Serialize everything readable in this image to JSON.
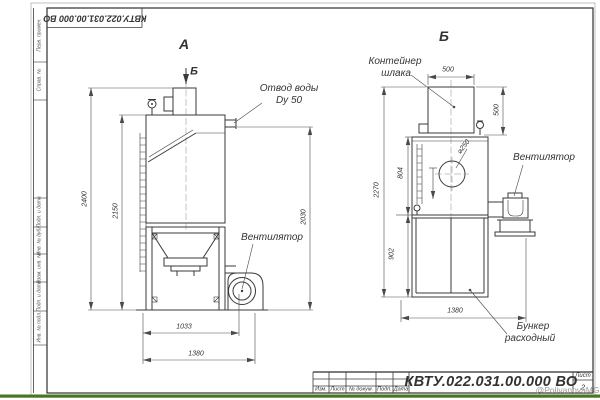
{
  "frame": {
    "top_designation": "КВТУ.022.031.00.000  ВО",
    "left_labels": {
      "perv": "Перв. примен.",
      "sprav": "Справ. №",
      "podp1": "Подп. и дата",
      "inv_dubl": "Инв. № дубл.",
      "vzam": "Взам. инв. №",
      "podp2": "Подп. и дата",
      "inv_podl": "Инв. № подл."
    }
  },
  "title_block": {
    "designation": "КВТУ.022.031.00.000  ВО",
    "cols": {
      "izm": "Изм.",
      "list": "Лист",
      "doc": "№ докум.",
      "podp": "Подп.",
      "data": "Дата"
    },
    "sheet_label": "Лист",
    "sheet_number": "2"
  },
  "watermark": {
    "text": "@PolivanovaMG2021"
  },
  "view_a": {
    "label": "А",
    "section_marker": "Б",
    "water_line1": "Отвод воды",
    "water_line2": "Dy 50",
    "fan_label": "Вентилятор",
    "dims": {
      "d2400": "2400",
      "d2150": "2150",
      "d2030": "2030",
      "d1033": "1033",
      "d1380": "1380"
    }
  },
  "view_b": {
    "label": "Б",
    "container_line1": "Контейнер",
    "container_line2": "шлака",
    "fan_label": "Вентилятор",
    "hopper_line1": "Бункер",
    "hopper_line2": "расходный",
    "dims": {
      "d500w": "500",
      "d500h": "500",
      "d250": "⌀250",
      "d804": "804",
      "d2270": "2270",
      "d902": "902",
      "d1380": "1380"
    }
  },
  "colors": {
    "line": "#3a3a3a",
    "accent_green": "#4a7524"
  }
}
